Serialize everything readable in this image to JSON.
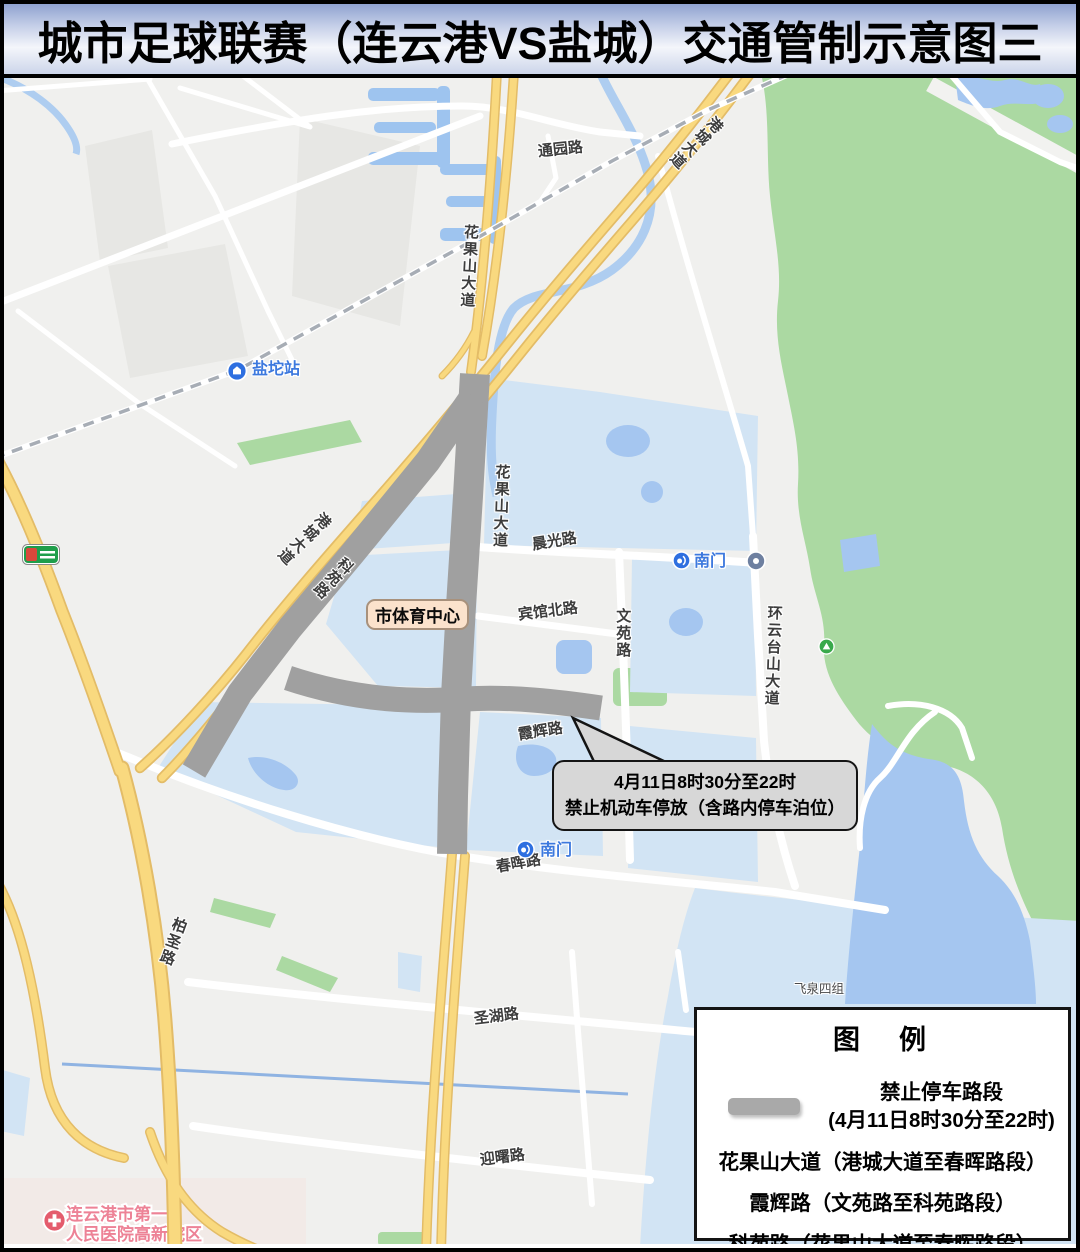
{
  "title": "城市足球联赛（连云港VS盐城）交通管制示意图三",
  "map": {
    "roads": {
      "tongyuan": "通园路",
      "gangcheng_n": "港城大道",
      "gangcheng_w": "港城大道",
      "huaguoshan_n": "花果山大道",
      "huaguoshan_mid": "花果山大道",
      "keyuan": "科苑路",
      "chenguang": "晨光路",
      "binguan_bei": "宾馆北路",
      "wenyuan": "文苑路",
      "huanyuntaishan": "环云台山大道",
      "xiahui": "霞辉路",
      "chunhui": "春晖路",
      "shenghu": "圣湖路",
      "yingshu": "迎曙路",
      "baisheng": "柏圣路"
    },
    "places": {
      "yantuo_station": "盐坨站",
      "nanmen_north": "南门",
      "nanmen_south": "南门",
      "stadium": "市体育中心",
      "feiquan": "飞泉四组",
      "hospital_line1": "连云港市第一",
      "hospital_line2": "人民医院高新院区"
    }
  },
  "callout": {
    "line1": "4月11日8时30分至22时",
    "line2": "禁止机动车停放（含路内停车泊位）"
  },
  "legend": {
    "title": "图　例",
    "no_parking_line1": "禁止停车路段",
    "no_parking_line2": "(4月11日8时30分至22时)",
    "items": [
      "花果山大道（港城大道至春晖路段）",
      "霞辉路（文苑路至科苑路段）",
      "科苑路（花果山大道至春晖路段）"
    ]
  },
  "colors": {
    "restricted_road": "#a0a0a0",
    "highway_yellow": "#f9d97f",
    "park_green": "#abd9a2",
    "water_light": "#d2e4f4",
    "water_deep": "#a5c6f0",
    "metro_blue": "#2e6fe0",
    "hospital_pink": "#ed8296"
  }
}
